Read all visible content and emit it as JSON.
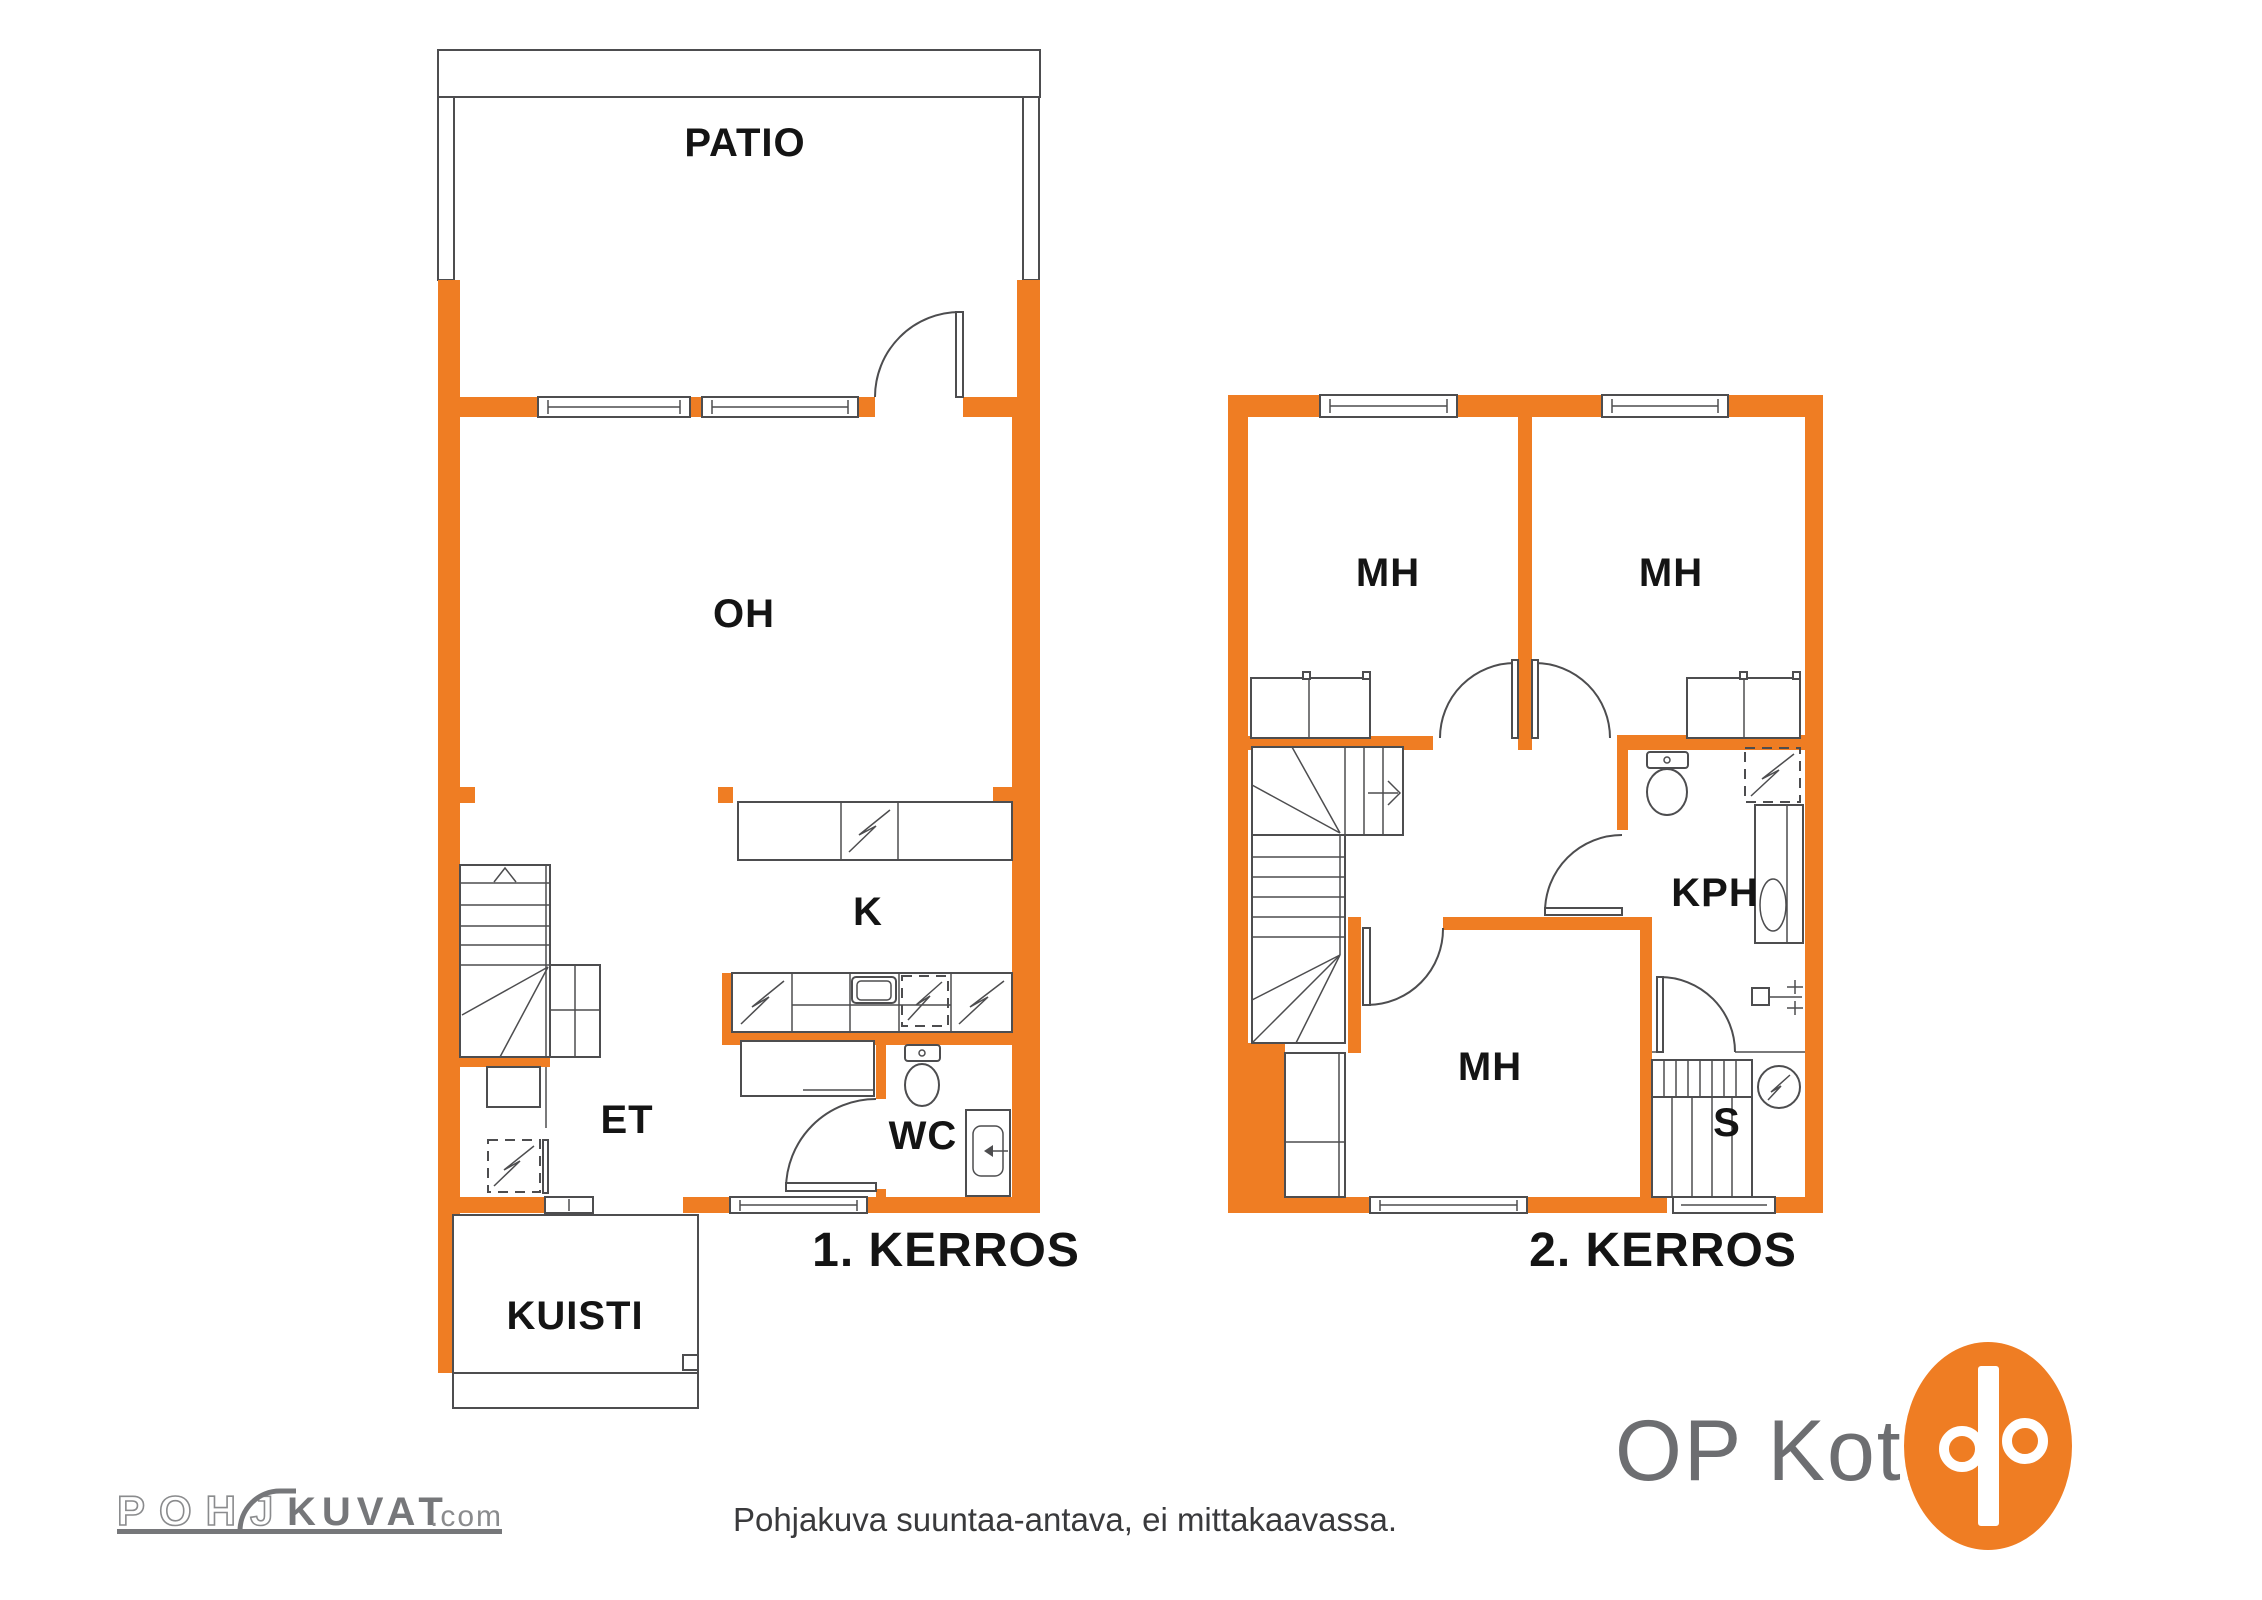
{
  "floor1": {
    "title": "1. KERROS",
    "rooms": {
      "patio": "PATIO",
      "living_room": "OH",
      "kitchen": "K",
      "entrance": "ET",
      "toilet": "WC",
      "porch": "KUISTI"
    }
  },
  "floor2": {
    "title": "2. KERROS",
    "rooms": {
      "bedroom_left": "MH",
      "bedroom_right": "MH",
      "bedroom_lower": "MH",
      "bathroom": "KPH",
      "sauna": "S"
    }
  },
  "footer": {
    "disclaimer": "Pohjakuva suuntaa-antava, ei mittakaavassa.",
    "brand_text": "OP Koti",
    "watermark": {
      "outline": "POHJ",
      "solid": "KUVAT",
      "suffix": ".com"
    }
  },
  "colors": {
    "wall_orange": "#EF7D23",
    "line_gray": "#4d4d4f",
    "brand_gray": "#6d6e71",
    "watermark_gray": "#77787a"
  }
}
